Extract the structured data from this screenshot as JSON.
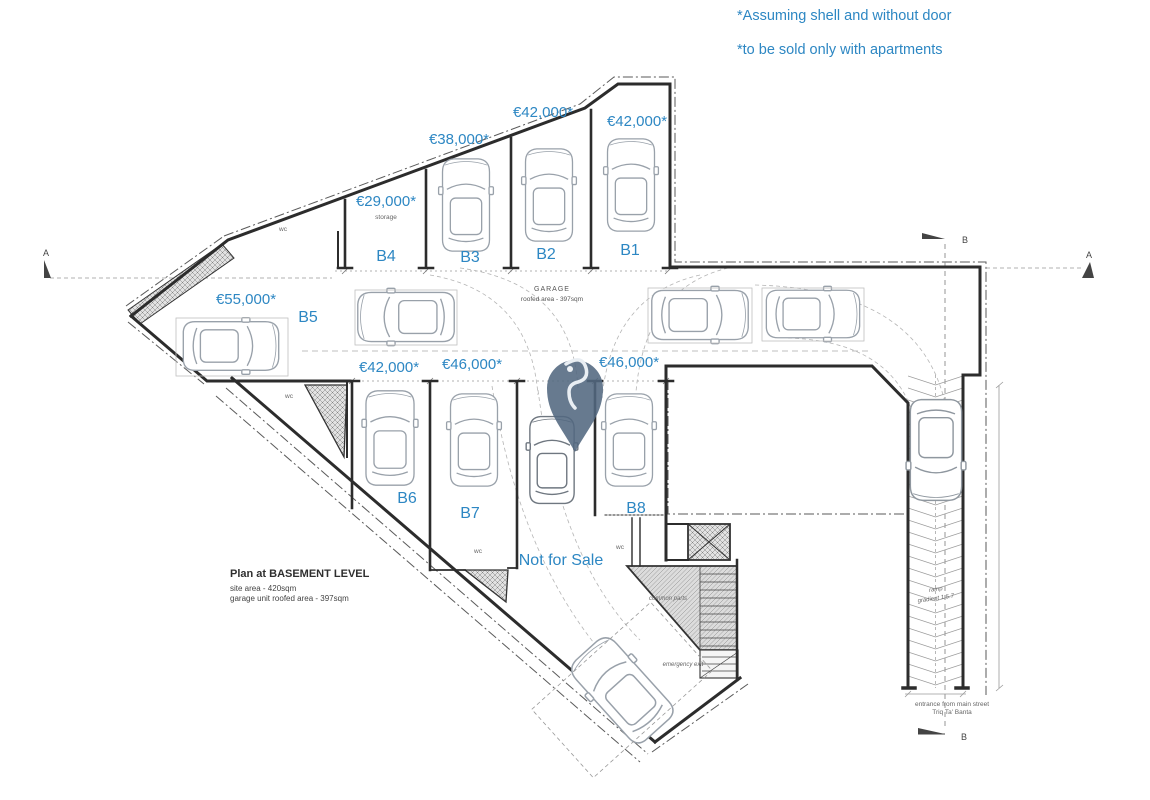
{
  "annotations": {
    "note1": "*Assuming shell and without door",
    "note2": "*to be sold only with apartments"
  },
  "garage": {
    "name": "GARAGE",
    "area": "roofed area - 397sqm"
  },
  "stalls": [
    {
      "id": "B1",
      "price": "€42,000*"
    },
    {
      "id": "B2",
      "price": "€42,000*"
    },
    {
      "id": "B3",
      "price": "€38,000*"
    },
    {
      "id": "B4",
      "price": "€29,000*",
      "note": "storage"
    },
    {
      "id": "B5",
      "price": "€55,000*"
    },
    {
      "id": "B6",
      "price": "€42,000*"
    },
    {
      "id": "B7",
      "price": "€46,000*"
    },
    {
      "id": "B8",
      "price": "€46,000*"
    }
  ],
  "labels": {
    "wc": "wc",
    "not_for_sale": "Not for Sale",
    "common_parts": "common parts",
    "emergency_exit": "emergency exit",
    "ramp": "ramp",
    "ramp_gradient": "gradient 1:5.7",
    "entrance_line1": "entrance from main street",
    "entrance_line2": "Triq Ta' Banta"
  },
  "title_block": {
    "title": "Plan at BASEMENT LEVEL",
    "site_area": "site area - 420sqm",
    "roofed_area": "garage unit roofed area - 397sqm"
  },
  "section": {
    "a": "A",
    "b": "B"
  },
  "colors": {
    "accent_blue": "#2d87c3",
    "pin": "#52687f",
    "wall": "#2c2c2c",
    "car_line": "#99a1aa"
  }
}
